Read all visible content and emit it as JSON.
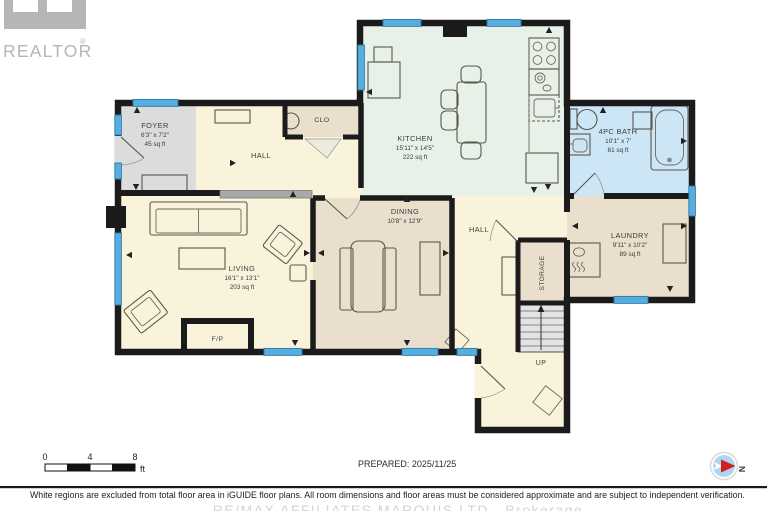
{
  "branding": {
    "logo_text": "REALTOR",
    "registered": "®"
  },
  "rooms": {
    "foyer": {
      "name": "FOYER",
      "dims": "6'3\" x 7'2\"",
      "area": "45 sq ft"
    },
    "hall_upper": {
      "name": "HALL"
    },
    "clo": {
      "name": "CLO"
    },
    "kitchen": {
      "name": "KITCHEN",
      "dims": "15'11\" x 14'5\"",
      "area": "222 sq ft"
    },
    "bath": {
      "name": "4PC BATH",
      "dims": "10'1\" x 7'",
      "area": "61 sq ft"
    },
    "dining": {
      "name": "DINING",
      "dims": "10'8\" x 12'9\""
    },
    "hall_center": {
      "name": "HALL"
    },
    "laundry": {
      "name": "LAUNDRY",
      "dims": "9'11\" x 10'2\"",
      "area": "89 sq ft"
    },
    "living": {
      "name": "LIVING",
      "dims": "16'1\" x 13'1\"",
      "area": "203 sq ft"
    },
    "storage": {
      "name": "STORAGE"
    },
    "stairs": {
      "label": "UP"
    },
    "fireplace": {
      "label": "F/P"
    }
  },
  "scale_bar": {
    "tick_0": "0",
    "tick_1": "4",
    "tick_2": "8",
    "unit": "ft"
  },
  "prepared_label": "PREPARED: 2025/11/25",
  "compass": {
    "label": "N"
  },
  "footer": {
    "disclaimer": "White regions are excluded from total floor area in iGUIDE floor plans. All room dimensions and floor areas must be considered approximate and are subject to independent verification.",
    "brokerage": "RE/MAX AFFILIATES MARQUIS LTD., Brokerage"
  },
  "colors": {
    "wall": "#1b1b1b",
    "floor_default": "#faf3dc",
    "floor_foyer": "#dcdcdc",
    "floor_kitchen": "#e7f1e8",
    "floor_bath": "#cde6f5",
    "floor_tan": "#eadfcc",
    "floor_stairs": "#e3e3e3",
    "window": "#56aede",
    "half_wall": "#a9a9a9",
    "logo_gray": "#b6b6b6",
    "compass_blue": "#aed6f1",
    "compass_red": "#d61f1f"
  }
}
